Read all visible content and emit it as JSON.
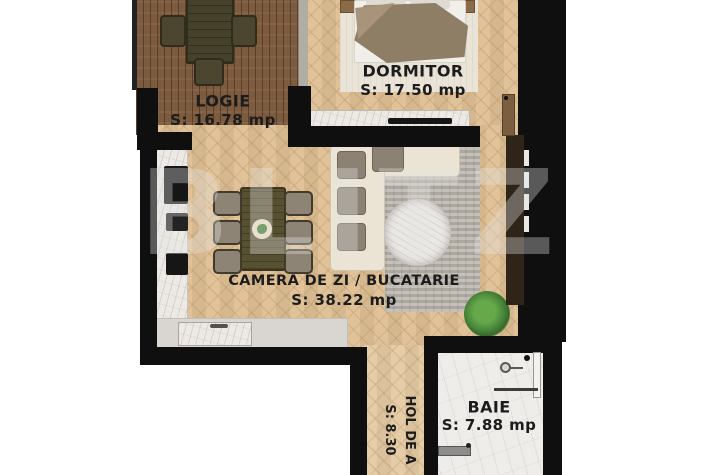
{
  "watermark": "BLITZ",
  "rooms": {
    "logie": {
      "name": "LOGIE",
      "area": "S: 16.78 mp"
    },
    "dormitor": {
      "name": "DORMITOR",
      "area": "S: 17.50 mp"
    },
    "living": {
      "name": "CAMERA DE ZI / BUCATARIE",
      "area": "S: 38.22 mp"
    },
    "baie": {
      "name": "BAIE",
      "area": "S: 7.88 mp"
    },
    "hol": {
      "name": "HOL DE A",
      "area": "S: 8.30"
    }
  },
  "colors": {
    "wall": "#0f0f0f",
    "wood_floor": "#dfbf94",
    "deck_floor": "#7d5b3f",
    "marble": "#edeae5",
    "label_text": "#1c1c1c"
  }
}
